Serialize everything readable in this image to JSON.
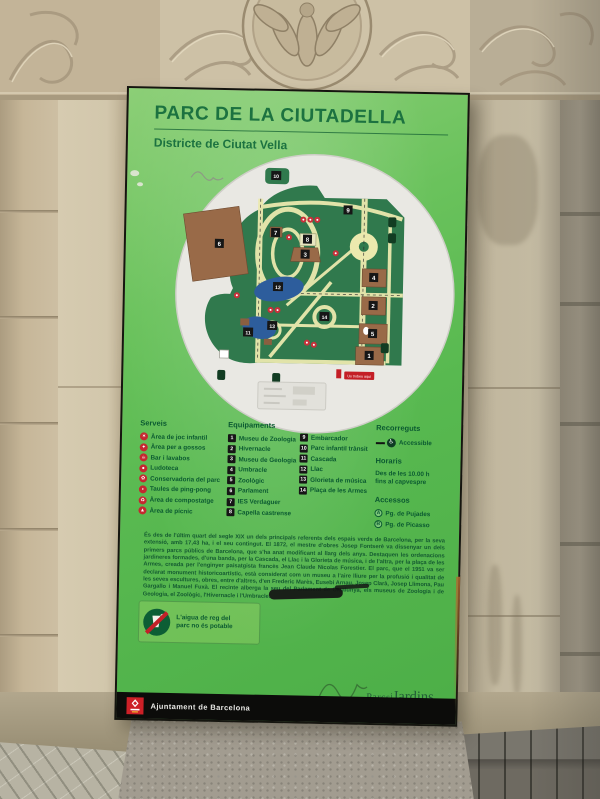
{
  "sign": {
    "title": "PARC DE LA CIUTADELLA",
    "subtitle": "Districte de Ciutat Vella",
    "map": {
      "you_are_here": "Us trobeu aquí"
    },
    "legend": {
      "serveis": {
        "header": "Serveis",
        "items": [
          {
            "label": "Àrea de joc infantil",
            "glyph": "✶"
          },
          {
            "label": "Àrea per a gossos",
            "glyph": "✦"
          },
          {
            "label": "Bar i lavabos",
            "glyph": "☕"
          },
          {
            "label": "Ludoteca",
            "glyph": "●"
          },
          {
            "label": "Conservadoria del parc",
            "glyph": "✿"
          },
          {
            "label": "Taules de ping-pong",
            "glyph": "◗"
          },
          {
            "label": "Àrea de compostatge",
            "glyph": "♻"
          },
          {
            "label": "Àrea de pícnic",
            "glyph": "▲"
          }
        ]
      },
      "equipaments": {
        "header": "Equipaments",
        "items": [
          {
            "num": "1",
            "label": "Museu de Zoologia"
          },
          {
            "num": "2",
            "label": "Hivernacle"
          },
          {
            "num": "3",
            "label": "Museu de Geologia"
          },
          {
            "num": "4",
            "label": "Umbracle"
          },
          {
            "num": "5",
            "label": "Zoològic"
          },
          {
            "num": "6",
            "label": "Parlament"
          },
          {
            "num": "7",
            "label": "IES Verdaguer"
          },
          {
            "num": "8",
            "label": "Capella castrense"
          },
          {
            "num": "9",
            "label": "Embarcador"
          },
          {
            "num": "10",
            "label": "Parc infantil trànsit"
          },
          {
            "num": "11",
            "label": "Cascada"
          },
          {
            "num": "12",
            "label": "Llac"
          },
          {
            "num": "13",
            "label": "Glorieta de música"
          },
          {
            "num": "14",
            "label": "Plaça de les Armes"
          }
        ]
      },
      "recorreguts": {
        "header": "Recorreguts",
        "accessible": "Accessible"
      },
      "horaris": {
        "header": "Horaris",
        "line1": "Des de les 10.00 h",
        "line2": "fins al capvespre"
      },
      "accessos": {
        "header": "Accessos",
        "items": [
          {
            "letter": "A",
            "label": "Pg. de Pujades"
          },
          {
            "letter": "B",
            "label": "Pg. de Picasso"
          }
        ]
      }
    },
    "description": "És des de l'últim quart del segle XIX un dels principals referents dels espais verds de Barcelona, per la seva extensió, amb 17,43 ha, i el seu contingut. El 1872, el mestre d'obres Josep Fontserè va dissenyar un dels primers parcs públics de Barcelona, que s'ha anat modificant al llarg dels anys. Destaquen les ordenacions jardineres formades, d'una banda, per la Cascada, el Llac i la Glorieta de música, i de l'altra, per la plaça de les Armes, creada per l'enginyer paisatgista francès Jean Claude Nicolas Forestier. El parc, que el 1951 va ser declarat monument historicoartístic, està considerat com un museu a l'aire lliure per la profusió i qualitat de les seves escultures, obres, entre d'altres, d'en Frederic Marès, Eusebi Arnau, Josep Clarà, Josep Llimona, Pau Gargallo i Manuel Fuxà. El recinte alberga la seu del Parlament de Catalunya, els museus de Zoologia i de Geologia, el Zoològic, l'Hivernacle i l'Umbracle.",
    "water_notice": "L'aigua de reg del parc no és potable",
    "footer": {
      "municipality": "Ajuntament de Barcelona",
      "brand": {
        "parcs": "Parcs",
        "i": "i",
        "jardins": "Jardins"
      }
    }
  }
}
